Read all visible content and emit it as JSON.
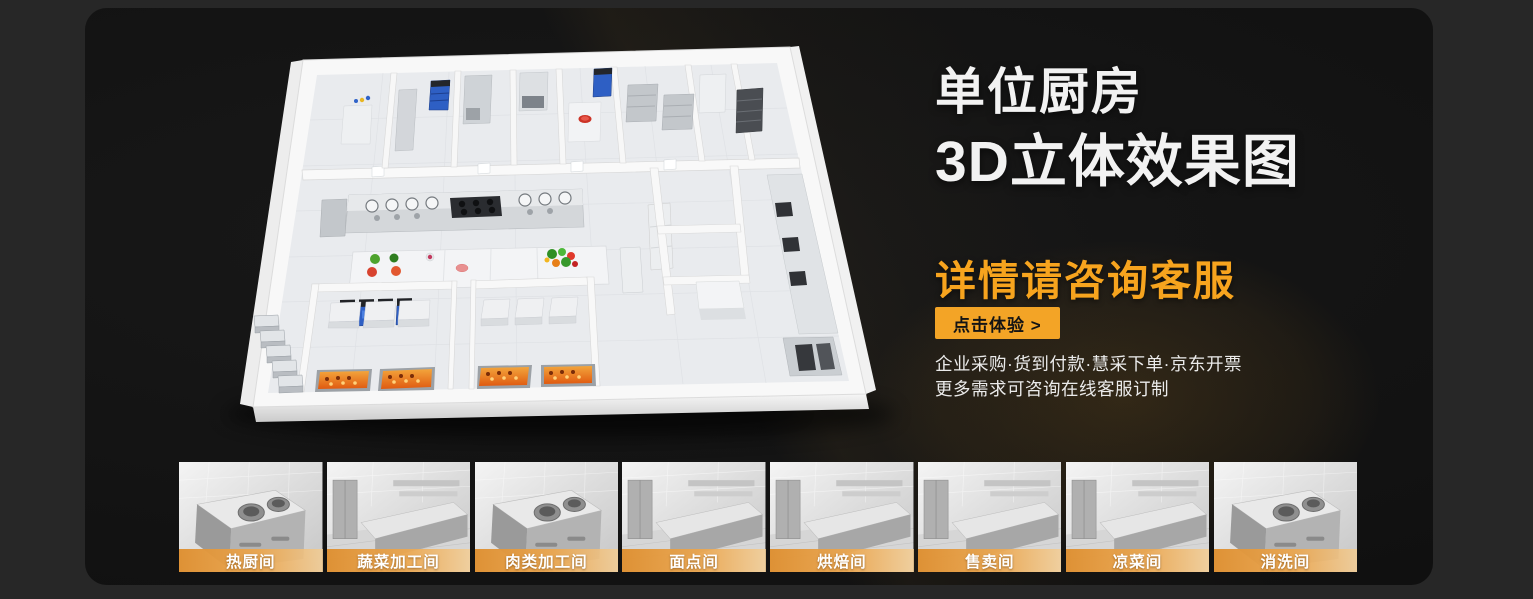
{
  "theme": {
    "outer_bg": "#272727",
    "panel_bg": "#141414",
    "accent_orange": "#F3A426",
    "heading_orange": "#F7A41E",
    "label_bar_from": "#DE8F30",
    "label_bar_to": "#F6CD8F"
  },
  "hero": {
    "title_line1": "单位厨房",
    "title_line2": "3D立体效果图",
    "subtitle": "详情请咨询客服",
    "cta_label": "点击体验 >",
    "features_line1": "企业采购·货到付款·慧采下单·京东开票",
    "features_line2": "更多需求可咨询在线客服订制"
  },
  "rooms": [
    {
      "label": "热厨间"
    },
    {
      "label": "蔬菜加工间"
    },
    {
      "label": "肉类加工间"
    },
    {
      "label": "面点间"
    },
    {
      "label": "烘焙间"
    },
    {
      "label": "售卖间"
    },
    {
      "label": "凉菜间"
    },
    {
      "label": "消洗间"
    }
  ]
}
